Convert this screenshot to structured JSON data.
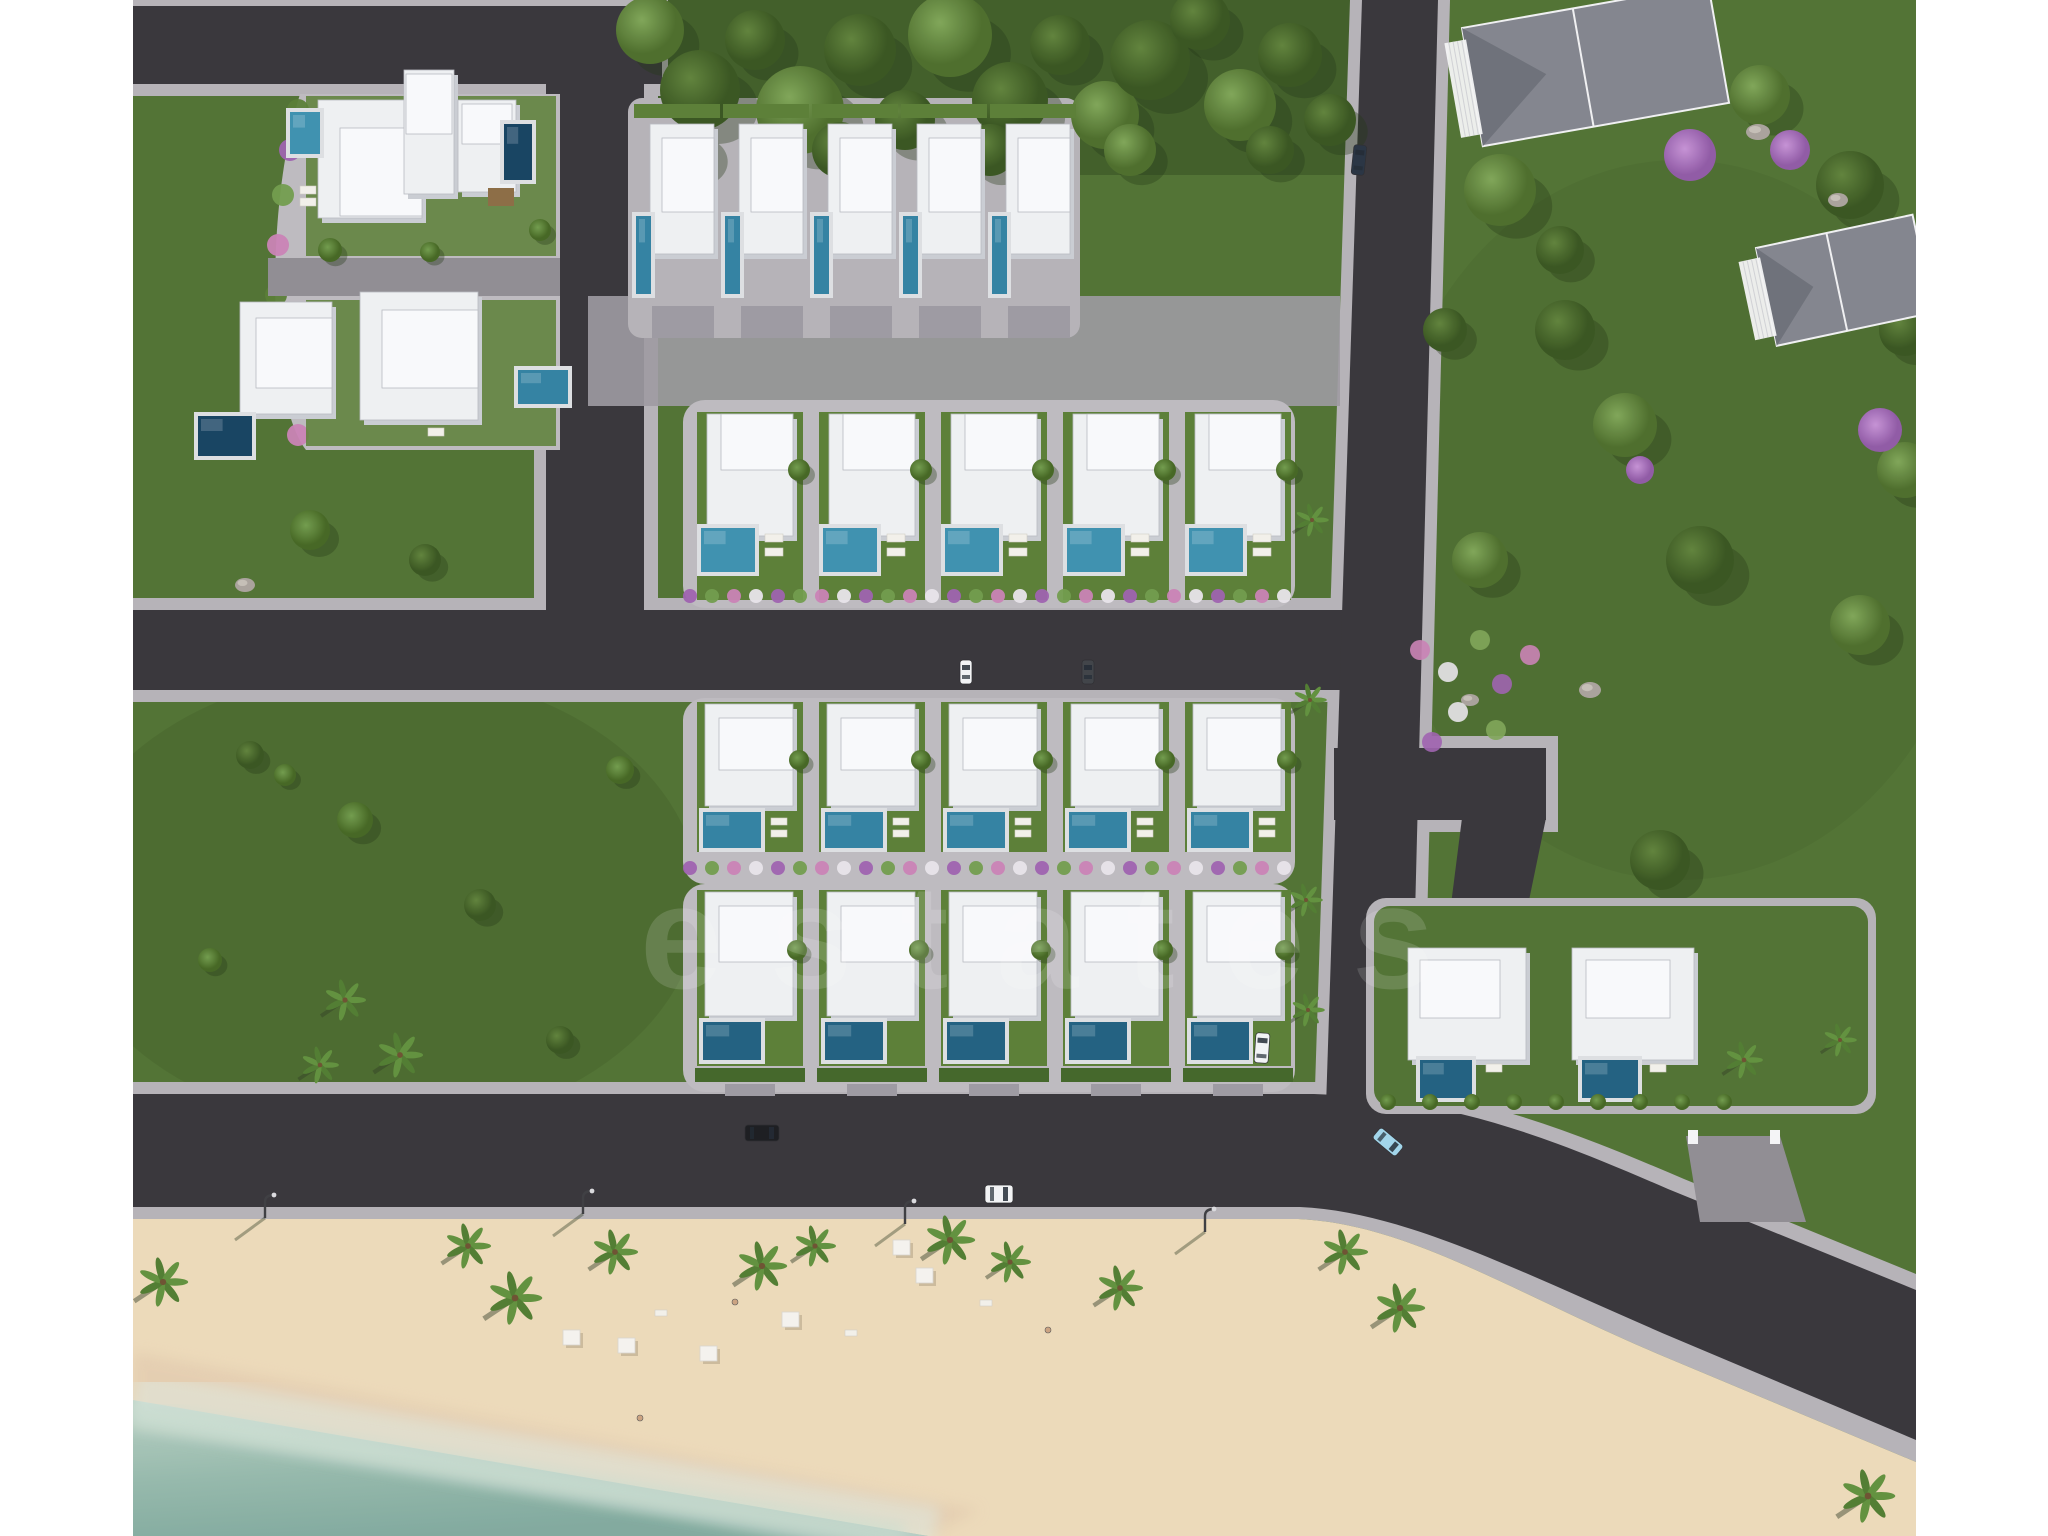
{
  "scene": {
    "type": "aerial-3d-render",
    "description": "Top-down architectural render of a beachfront villa development with roads, gardens, pools, beach and sea",
    "watermark": "estates"
  },
  "palette": {
    "pageMargin": "#ffffff",
    "grass": "#4e7030",
    "grassDark": "#425f26",
    "parkGrass": "#48682b",
    "forestDark": "#2f4a1e",
    "roadDark": "#343237",
    "roadMid": "#8e8b91",
    "sidewalk": "#b4b1b6",
    "platform": "#bcb9be",
    "paver": "#9b98a0",
    "gardenGreen": "#587c33",
    "villa": "#eef0f2",
    "villaTop": "#f8f9fb",
    "villaShade": "#c9ccd2",
    "villaEdge": "#b7bac0",
    "poolTeal": "#2f7fa0",
    "poolTeal2": "#3a8fae",
    "poolDark": "#1d5d7e",
    "poolNavy": "#123f5e",
    "deck": "#dcdee2",
    "sand": "#ecd9b8",
    "sandWet": "#e3cbae",
    "seaShallow": "#a9c6b8",
    "seaDeep": "#7fa89c",
    "foam": "#dfe9e2",
    "greyRoof": "#80838c",
    "greyRoofDark": "#6b6e77",
    "railWhite": "#f4f4f6",
    "trunk": "#6b4f2e",
    "rock": "#a8a19a",
    "flowerPink": "#c97fb4",
    "flowerPurple": "#9c5fae",
    "flowerWhite": "#e8e4ea",
    "carBlack": "#17181c",
    "carWhite": "#f2f3f5",
    "carBlue": "#9fd4ea",
    "carNavy": "#25303f",
    "lamp": "#3a3a3e"
  },
  "development": {
    "rows": [
      {
        "id": "row-1-north",
        "villas": 5,
        "pools": 5,
        "pool_style": "narrow-vertical"
      },
      {
        "id": "row-2",
        "villas": 5,
        "pools": 5,
        "pool_style": "square"
      },
      {
        "id": "row-3",
        "villas": 5,
        "pools": 5,
        "pool_style": "wide"
      },
      {
        "id": "row-4-seafront",
        "villas": 5,
        "pools": 5,
        "pool_style": "wide"
      },
      {
        "id": "northwest-compound",
        "villas": 4,
        "pools": 4,
        "pool_style": "mixed"
      },
      {
        "id": "east-seafront-pair",
        "villas": 2,
        "pools": 2,
        "pool_style": "wide"
      }
    ],
    "neighbor_houses": 2
  },
  "vehicles": [
    {
      "color": "black",
      "location": "main-coastal-road"
    },
    {
      "color": "white",
      "location": "main-coastal-road-south-edge"
    },
    {
      "color": "light-blue",
      "location": "junction-curve"
    },
    {
      "color": "white",
      "location": "east-vertical-road"
    },
    {
      "color": "dark-navy",
      "location": "east-vertical-road-top"
    },
    {
      "color": "white",
      "location": "row-2-driveway"
    },
    {
      "color": "dark",
      "location": "row-2-driveway"
    }
  ],
  "beach": {
    "palms": 12,
    "cabanas": 6,
    "loungers": 3,
    "street_lamps": 4,
    "people": 3
  }
}
